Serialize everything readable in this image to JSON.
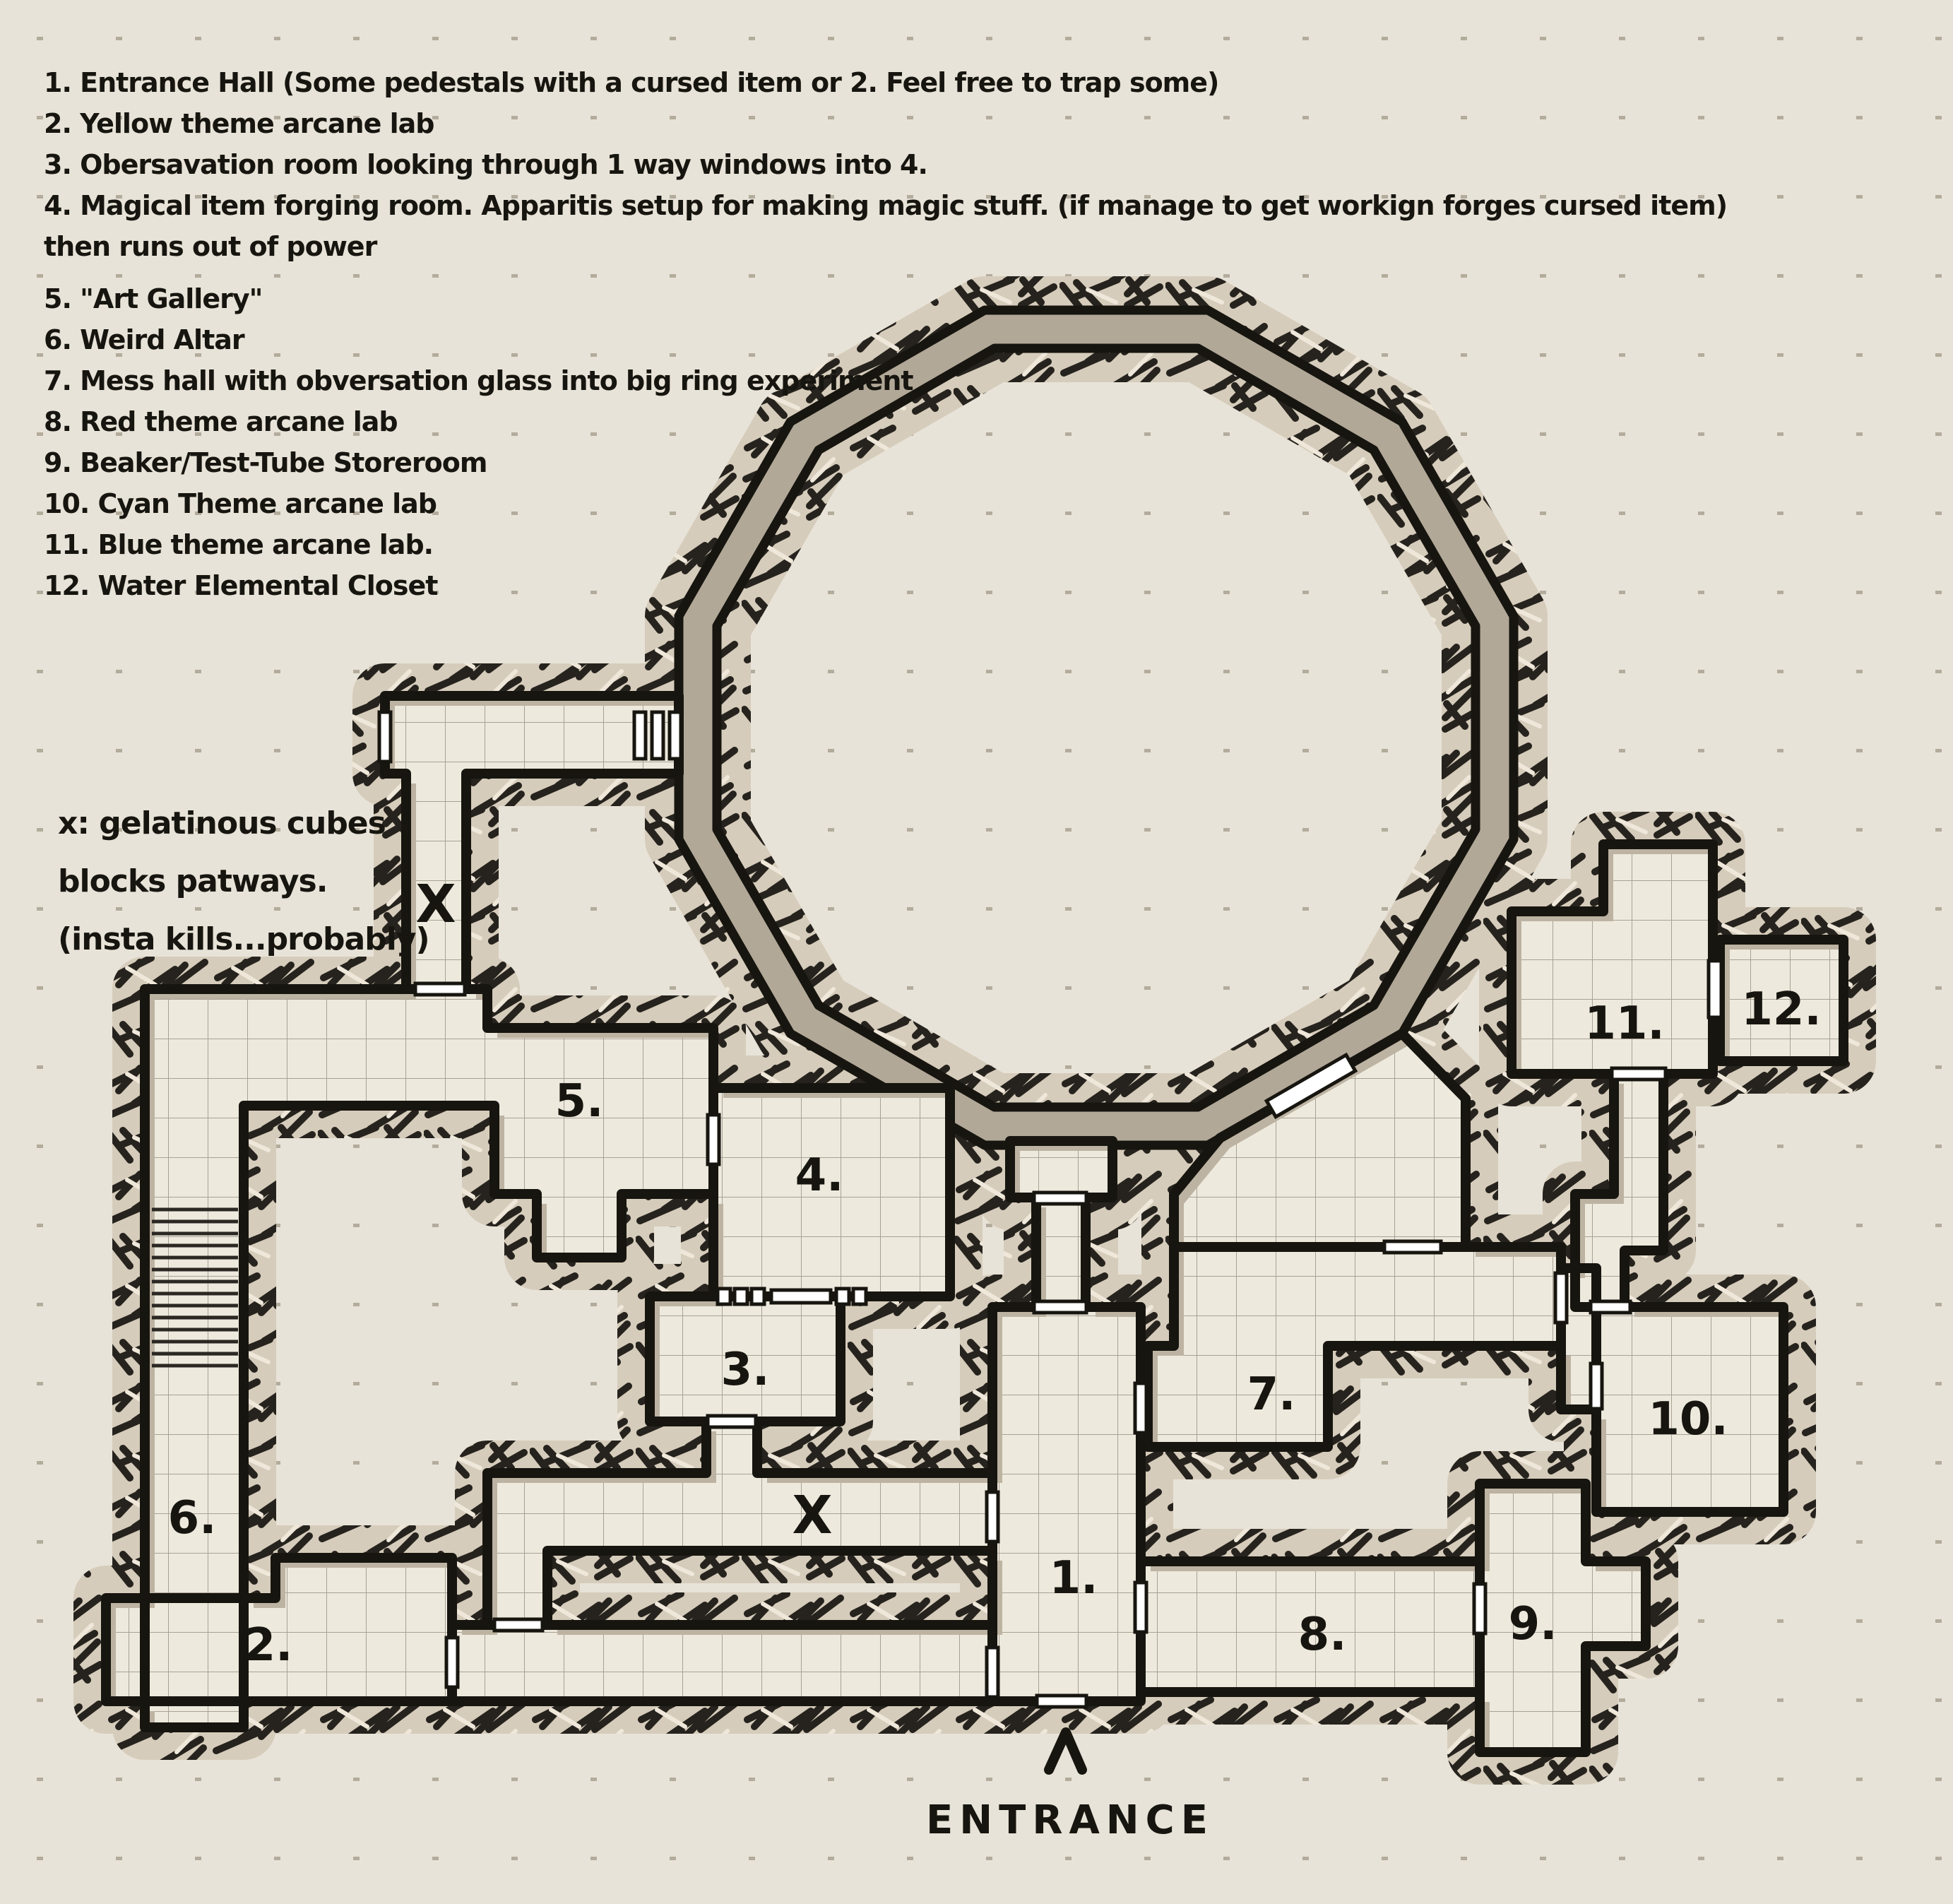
{
  "palette": {
    "paper": "#e8e3d8",
    "floor": "#ede9dd",
    "wall_ink": "#17150f",
    "rock_base": "#d6ccbb",
    "ring_floor": "#b1a898",
    "shadow": "#bdb3a2",
    "door_fill": "#ffffff"
  },
  "legend": {
    "items": [
      "1. Entrance Hall (Some pedestals with a cursed item or 2. Feel free to trap some)",
      "2. Yellow theme arcane lab",
      "3. Obersavation room looking through 1 way windows into 4.",
      "4. Magical item forging room. Apparitis setup for making magic stuff. (if manage to get workign forges cursed item)",
      "then runs out of power",
      "5. \"Art Gallery\"",
      "6. Weird Altar",
      "7. Mess hall with obversation glass into big ring experiment",
      "8. Red theme arcane lab",
      "9. Beaker/Test-Tube Storeroom",
      "10. Cyan Theme arcane lab",
      "11. Blue theme arcane lab.",
      "12. Water Elemental Closet"
    ]
  },
  "note": {
    "lines": [
      "x: gelatinous cubes",
      "blocks patways.",
      "(insta kills...probably)"
    ]
  },
  "map": {
    "rooms": [
      {
        "label": "1."
      },
      {
        "label": "2."
      },
      {
        "label": "3."
      },
      {
        "label": "4."
      },
      {
        "label": "5."
      },
      {
        "label": "6."
      },
      {
        "label": "7."
      },
      {
        "label": "8."
      },
      {
        "label": "9."
      },
      {
        "label": "10."
      },
      {
        "label": "11."
      },
      {
        "label": "12."
      }
    ],
    "cube_mark": "X",
    "entrance": {
      "label": "ENTRANCE"
    }
  }
}
